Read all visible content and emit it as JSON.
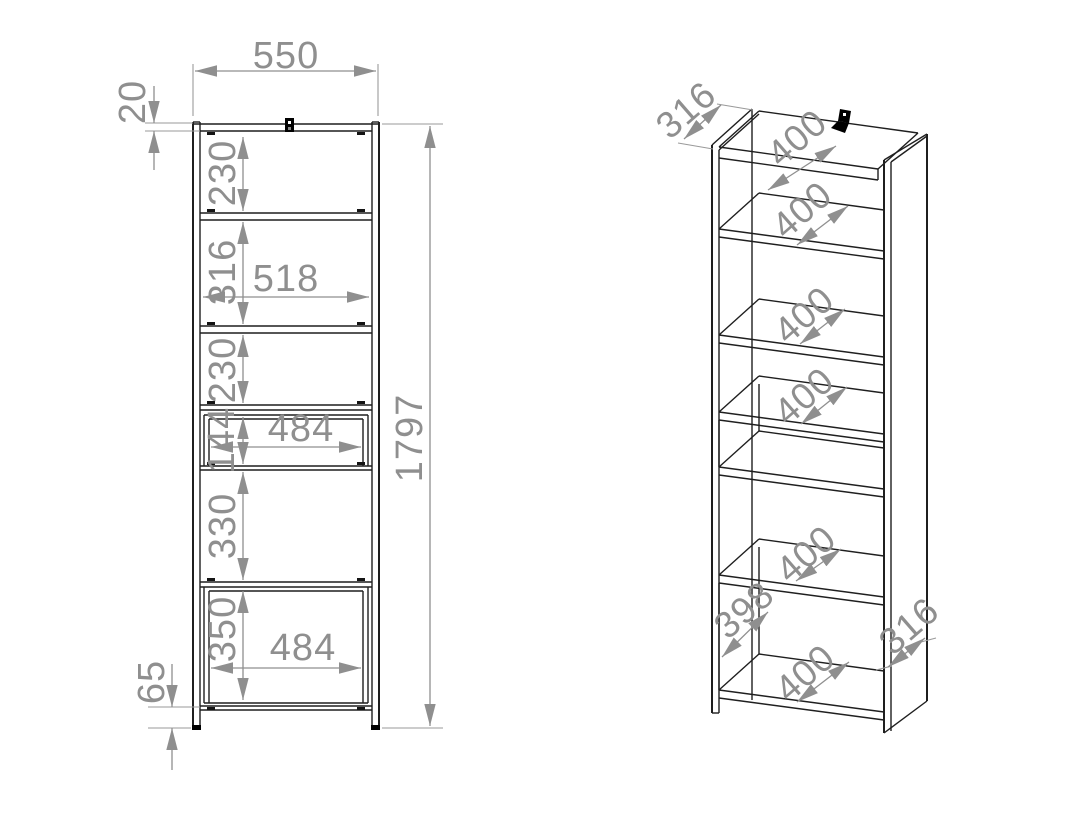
{
  "meta": {
    "background": "#ffffff",
    "line_color": "#1f1f1f",
    "dimension_color": "#8f8f8f",
    "bracket_color": "#000000"
  },
  "front_view": {
    "label_width_top": "550",
    "label_top_thickness": "20",
    "label_gap_1": "230",
    "label_gap_2": "316",
    "label_inner_width": "518",
    "label_gap_3": "230",
    "label_drawer_height": "144",
    "label_drawer_width": "484",
    "label_gap_4": "330",
    "label_gap_5": "350",
    "label_bottom_width": "484",
    "label_leg_height": "65",
    "label_total_height": "1797"
  },
  "iso_view": {
    "label_depth_top": "316",
    "label_shelf_top": "400",
    "label_shelf_2": "400",
    "label_shelf_3": "400",
    "label_shelf_4": "400",
    "label_shelf_5": "400",
    "label_inner_bottom_width": "398",
    "label_shelf_bottom": "400",
    "label_depth_side": "316"
  }
}
